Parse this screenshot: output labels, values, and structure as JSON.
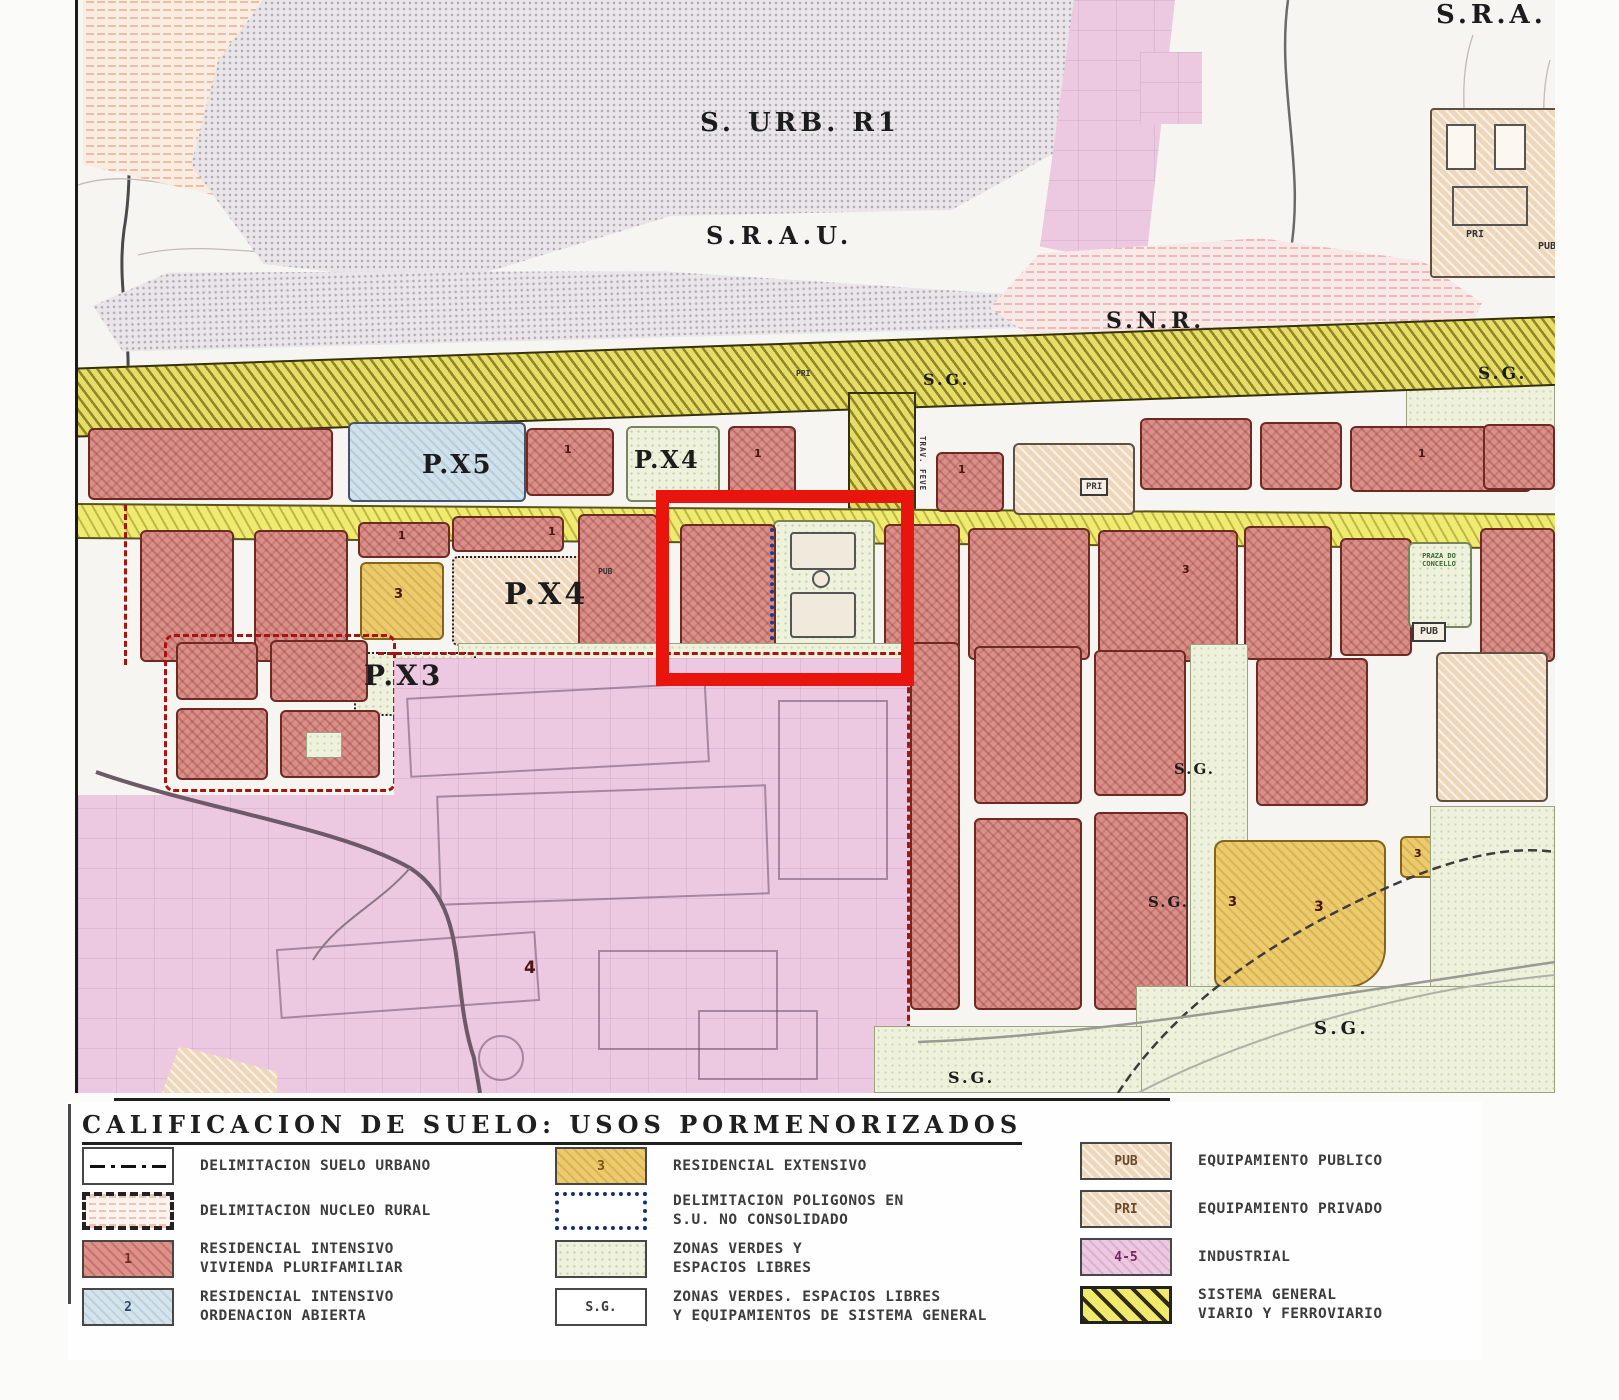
{
  "map": {
    "labels": {
      "s_urb_r1": "S. URB. R1",
      "srau": "S.R.A.U.",
      "sra": "S.R.A.",
      "snr": "S.N.R.",
      "sg": "S.G.",
      "px5": "P.X5",
      "px4": "P.X4",
      "px3": "P.X3",
      "pub": "PUB",
      "pri": "PRI",
      "praza": "PRAZA DO CONCELLO",
      "trav_feve": "TRAV. FEVE",
      "n1": "1",
      "n3": "3",
      "n4": "4"
    },
    "highlight_color": "#e8150f"
  },
  "legend": {
    "title": "CALIFICACION DE SUELO: USOS PORMENORIZADOS",
    "items": [
      {
        "key": "delimitacion-suelo-urbano",
        "swatch": "",
        "text": "DELIMITACION SUELO URBANO"
      },
      {
        "key": "delimitacion-nucleo-rural",
        "swatch": "",
        "text": "DELIMITACION NUCLEO RURAL"
      },
      {
        "key": "residencial-intensivo-plurifamiliar",
        "swatch": "1",
        "text": "RESIDENCIAL INTENSIVO\nVIVIENDA PLURIFAMILIAR"
      },
      {
        "key": "residencial-intensivo-abierta",
        "swatch": "2",
        "text": "RESIDENCIAL INTENSIVO\nORDENACION ABIERTA"
      },
      {
        "key": "residencial-extensivo",
        "swatch": "3",
        "text": "RESIDENCIAL  EXTENSIVO"
      },
      {
        "key": "delimitacion-poligonos",
        "swatch": "",
        "text": "DELIMITACION POLIGONOS EN\nS.U. NO CONSOLIDADO"
      },
      {
        "key": "zonas-verdes",
        "swatch": "",
        "text": "ZONAS VERDES Y\nESPACIOS LIBRES"
      },
      {
        "key": "zonas-verdes-sg",
        "swatch": "S.G.",
        "text": "ZONAS VERDES. ESPACIOS LIBRES\nY EQUIPAMIENTOS DE SISTEMA GENERAL"
      },
      {
        "key": "equipamiento-publico",
        "swatch": "PUB",
        "text": "EQUIPAMIENTO PUBLICO"
      },
      {
        "key": "equipamiento-privado",
        "swatch": "PRI",
        "text": "EQUIPAMIENTO PRIVADO"
      },
      {
        "key": "industrial",
        "swatch": "4-5",
        "text": "INDUSTRIAL"
      },
      {
        "key": "sistema-general-viario",
        "swatch": "",
        "text": "SISTEMA GENERAL\nVIARIO Y FERROVIARIO"
      }
    ]
  },
  "colors": {
    "highlight": "#e8150f",
    "residential_intensive": "#d9908a",
    "residential_open": "#cfe1ea",
    "residential_extensive": "#eccb6d",
    "industrial": "#ecc9e0",
    "green_zones": "#eef2dc",
    "equipment": "#eed7ba",
    "viario": "#e6dd68"
  }
}
